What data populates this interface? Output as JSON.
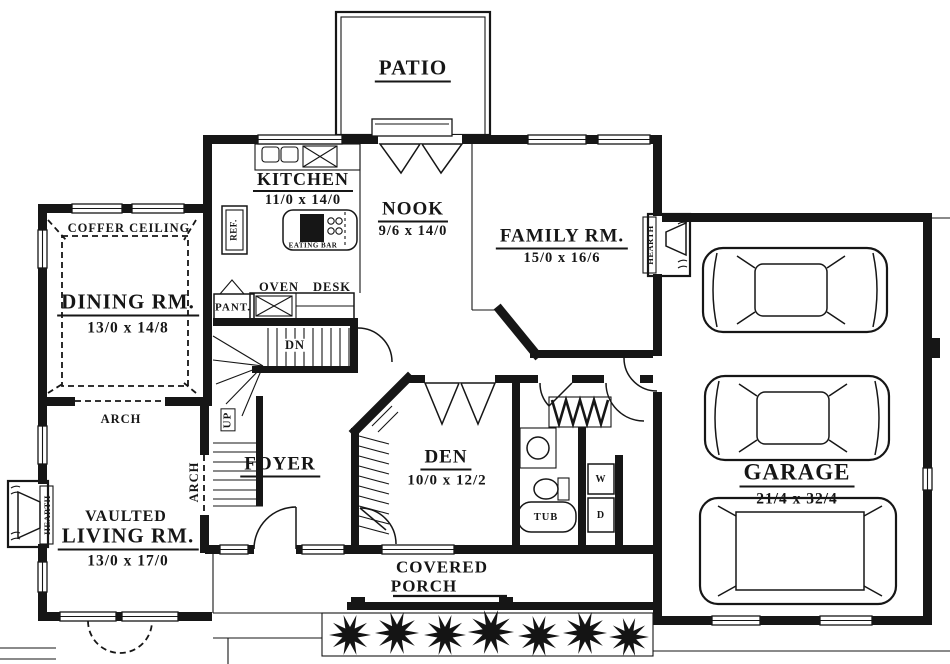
{
  "rooms": {
    "patio": {
      "name": "PATIO"
    },
    "kitchen": {
      "name": "KITCHEN",
      "dims": "11/0 x 14/0"
    },
    "nook": {
      "name": "NOOK",
      "dims": "9/6 x 14/0"
    },
    "family": {
      "name": "FAMILY RM.",
      "dims": "15/0 x 16/6"
    },
    "dining": {
      "name": "DINING RM.",
      "dims": "13/0 x 14/8",
      "ceiling": "COFFER CEILING"
    },
    "living": {
      "prefix": "VAULTED",
      "name": "LIVING RM.",
      "dims": "13/0 x 17/0"
    },
    "foyer": {
      "name": "FOYER"
    },
    "den": {
      "name": "DEN",
      "dims": "10/0 x 12/2"
    },
    "garage": {
      "name": "GARAGE",
      "dims": "21/4 x 32/4"
    },
    "porch": {
      "line1": "COVERED",
      "line2": "PORCH"
    }
  },
  "fixtures": {
    "eating_bar": "EATING BAR",
    "ref": "REF.",
    "pantry": "PANT.",
    "oven": "OVEN",
    "desk": "DESK",
    "stairs_down": "DN",
    "stairs_up": "UP",
    "arch": "ARCH",
    "hearth": "HEARTH",
    "tub": "TUB",
    "washer": "W",
    "dryer": "D"
  },
  "colors": {
    "ink": "#161616",
    "paper": "#ffffff"
  }
}
